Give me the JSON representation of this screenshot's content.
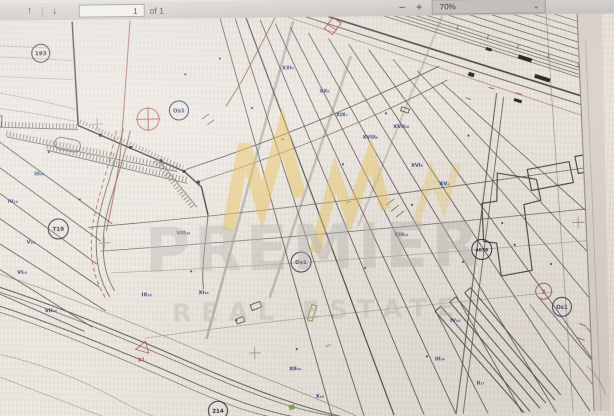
{
  "viewer_toolbar": {
    "prev_icon": "↑",
    "next_icon": "↓",
    "page_input_value": "1",
    "page_count_label": "of 1",
    "zoom_out_label": "−",
    "zoom_in_label": "+",
    "zoom_select_value": "70%",
    "caret_icon": "⌄"
  },
  "watermark": {
    "line1": "PREMIER",
    "line2": "REAL ESTATE",
    "logo_color": "#e9bf52",
    "text_color": "#b6b2ae"
  },
  "plan": {
    "circled_labels": [
      {
        "text": "193",
        "color": "#2b2a30"
      },
      {
        "text": "T19",
        "color": "#2b2a30"
      },
      {
        "text": "Os1",
        "color": "#1f3a78"
      },
      {
        "text": "Os1",
        "color": "#1f3a78"
      },
      {
        "text": "4036",
        "color": "#2b2a30"
      },
      {
        "text": "2",
        "color": "#a8554c"
      },
      {
        "text": "Os1",
        "color": "#1f3a78"
      },
      {
        "text": "214",
        "color": "#2b2a30"
      }
    ],
    "roman_labels": [
      {
        "text": "XXI₉"
      },
      {
        "text": "XX₈"
      },
      {
        "text": "XIX₇"
      },
      {
        "text": "XVIII₆"
      },
      {
        "text": "XVII₂₆"
      },
      {
        "text": "XVI₅"
      },
      {
        "text": "XV₄"
      },
      {
        "text": "XIII₁₂"
      },
      {
        "text": "VIII₃₄"
      },
      {
        "text": "IX₃₃"
      },
      {
        "text": "XI₃₅"
      },
      {
        "text": "III₂₀"
      },
      {
        "text": "IV₁₉"
      },
      {
        "text": "V₁₈"
      },
      {
        "text": "VI₁₆"
      },
      {
        "text": "VII₄₂"
      },
      {
        "text": "IV₁₅"
      },
      {
        "text": "III₁₆"
      },
      {
        "text": "II₁₇"
      },
      {
        "text": "XII₁₄"
      },
      {
        "text": "X₁₀"
      }
    ],
    "red_label": {
      "text": "21",
      "color": "#a5544a"
    },
    "colors": {
      "paper": "#ece7e0",
      "line_dark": "#433f3c",
      "line_medium": "#6e6963",
      "line_light": "#a59c92",
      "red": "#a5544a",
      "blue": "#2a457e",
      "green": "#6f9c3e",
      "gold": "#e9bf52"
    }
  }
}
